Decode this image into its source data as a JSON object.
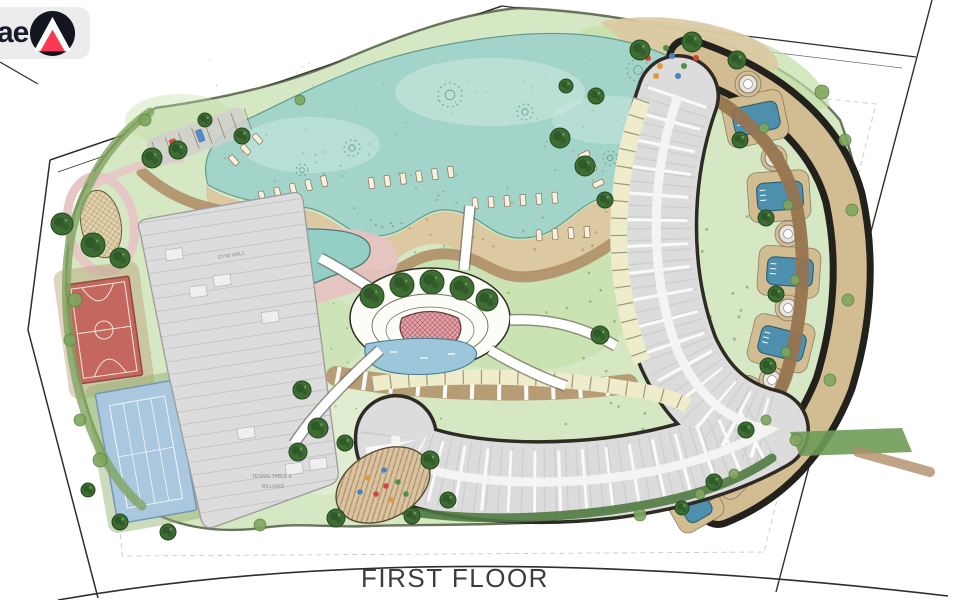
{
  "labels": {
    "floor": "FIRST FLOOR",
    "gym_hall": "GYM HALL",
    "games_room_1": "TENNIS TABLE &",
    "games_room_2": "BILLIARD"
  },
  "logo": {
    "text": "ae"
  },
  "palette": {
    "ink": "#2e2e2c",
    "boundary_faint": "#c9c9c9",
    "site_stroke": "#3d4a33",
    "lawn": "#d6e7c3",
    "lawn_bright": "#c2dfa6",
    "lawn_pale": "#e4efd5",
    "lagoon": "#a3d4c9",
    "lagoon_light": "#c9e8e0",
    "lagoon_edge": "#5f9c90",
    "sand": "#dcc9a2",
    "sand2": "#d2bd92",
    "sand_speck": "#9b8560",
    "prom": "#b08f68",
    "pool": "#4e8fae",
    "pool_edge": "#2c5e78",
    "pool_kid": "#93cfc5",
    "pool_kid_edge": "#4e7a74",
    "pond": "#9cc7da",
    "pond_edge": "#4a7a94",
    "deck_pink": "#e6c3c2",
    "path_pink": "#e7c6c6",
    "bldg": "#dcdcdc",
    "bldg_edge": "#2e2b24",
    "bldg_line": "#b5b5b5",
    "bldg_white": "#f4f4f2",
    "bldg_gray_edge": "#9b9b9b",
    "cream": "#eeeccb",
    "cream_tick": "#8a8a70",
    "brown": "#96744f",
    "dark_crescent": "#23211c",
    "court_red": "#c4685f",
    "court_red_edge": "#8f4a42",
    "court_line": "#f0e8e0",
    "court_blue": "#a9c8e0",
    "court_blue_edge": "#7596b5",
    "tree": "#3e6d33",
    "tree_dark": "#2a5124",
    "tree_edge": "#24471f",
    "bush": "#7fa55f",
    "hedge": "#4f7a41",
    "grass_strip": "#6f9b57",
    "amph": "#e0a7ad",
    "amph_edge": "#6a3c40",
    "tan_oval": "#d9c3a0",
    "oval_hatch": "#ab8f68",
    "chair": "#f6f0e1",
    "chair_edge": "#8a6f4f",
    "text_dark": "#3c3c3c",
    "text_faint": "#8f8f8f",
    "dot_red": "#cf4636",
    "dot_orange": "#e09a3c",
    "dot_blue": "#4a82bd",
    "dot_green": "#4e8f45",
    "logo_bg": "#ececec",
    "logo_ink": "#191b2c",
    "logo_mark": "#14161f",
    "logo_red": "#f93a52"
  }
}
